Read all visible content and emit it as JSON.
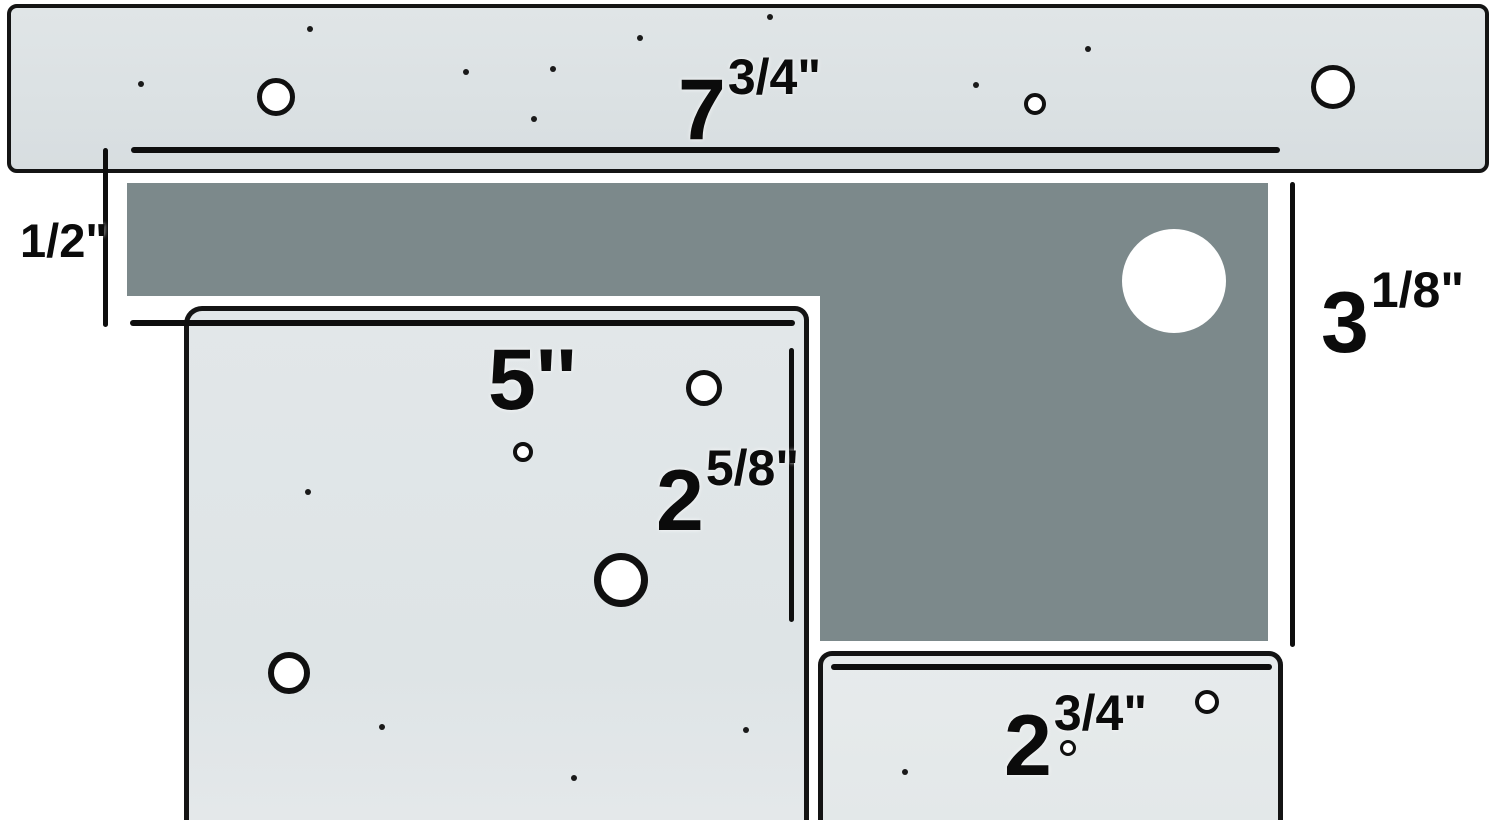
{
  "diagram_title": "plate-dimension-diagram",
  "colors": {
    "background": "#ffffff",
    "plate_fill": "#dee3e5",
    "plate_fill_light": "#e6eaeb",
    "dark_region_fill": "#7c898b",
    "line": "#0e0e0e"
  },
  "dimensions": {
    "top_width": {
      "main": "7",
      "sup": "3/4\""
    },
    "left_gap": {
      "text": "1/2\""
    },
    "right_height": {
      "main": "3",
      "sup": "1/8\""
    },
    "five_width": {
      "main": "5''",
      "sup": ""
    },
    "five_height": {
      "main": "2",
      "sup": "5/8\""
    },
    "small_width": {
      "main": "2",
      "sup": "3/4\""
    }
  },
  "plates": {
    "top": {
      "holes": [
        {
          "x": 276,
          "y": 97,
          "r": 19,
          "s": 5
        },
        {
          "x": 1035,
          "y": 104,
          "r": 11,
          "s": 4
        },
        {
          "x": 1333,
          "y": 87,
          "r": 22,
          "s": 5
        }
      ],
      "dots": [
        {
          "x": 141,
          "y": 84,
          "r": 3
        },
        {
          "x": 310,
          "y": 29,
          "r": 3
        },
        {
          "x": 466,
          "y": 72,
          "r": 3
        },
        {
          "x": 553,
          "y": 69,
          "r": 3
        },
        {
          "x": 534,
          "y": 119,
          "r": 3
        },
        {
          "x": 640,
          "y": 38,
          "r": 3
        },
        {
          "x": 770,
          "y": 17,
          "r": 3
        },
        {
          "x": 976,
          "y": 85,
          "r": 3
        },
        {
          "x": 1088,
          "y": 49,
          "r": 3
        }
      ]
    },
    "five": {
      "holes": [
        {
          "x": 704,
          "y": 388,
          "r": 18,
          "s": 5
        },
        {
          "x": 523,
          "y": 452,
          "r": 10,
          "s": 4
        },
        {
          "x": 621,
          "y": 580,
          "r": 27,
          "s": 7
        },
        {
          "x": 289,
          "y": 673,
          "r": 21,
          "s": 6
        }
      ],
      "dots": [
        {
          "x": 308,
          "y": 492,
          "r": 3
        },
        {
          "x": 382,
          "y": 727,
          "r": 3
        },
        {
          "x": 574,
          "y": 778,
          "r": 3
        },
        {
          "x": 746,
          "y": 730,
          "r": 3
        }
      ]
    },
    "small": {
      "holes": [
        {
          "x": 1207,
          "y": 702,
          "r": 12,
          "s": 4
        },
        {
          "x": 1068,
          "y": 748,
          "r": 8,
          "s": 3
        }
      ],
      "dots": [
        {
          "x": 905,
          "y": 772,
          "r": 3
        }
      ]
    }
  },
  "dark_region": {
    "cutout_circle": {
      "x": 1174,
      "y": 281,
      "r": 52
    }
  }
}
